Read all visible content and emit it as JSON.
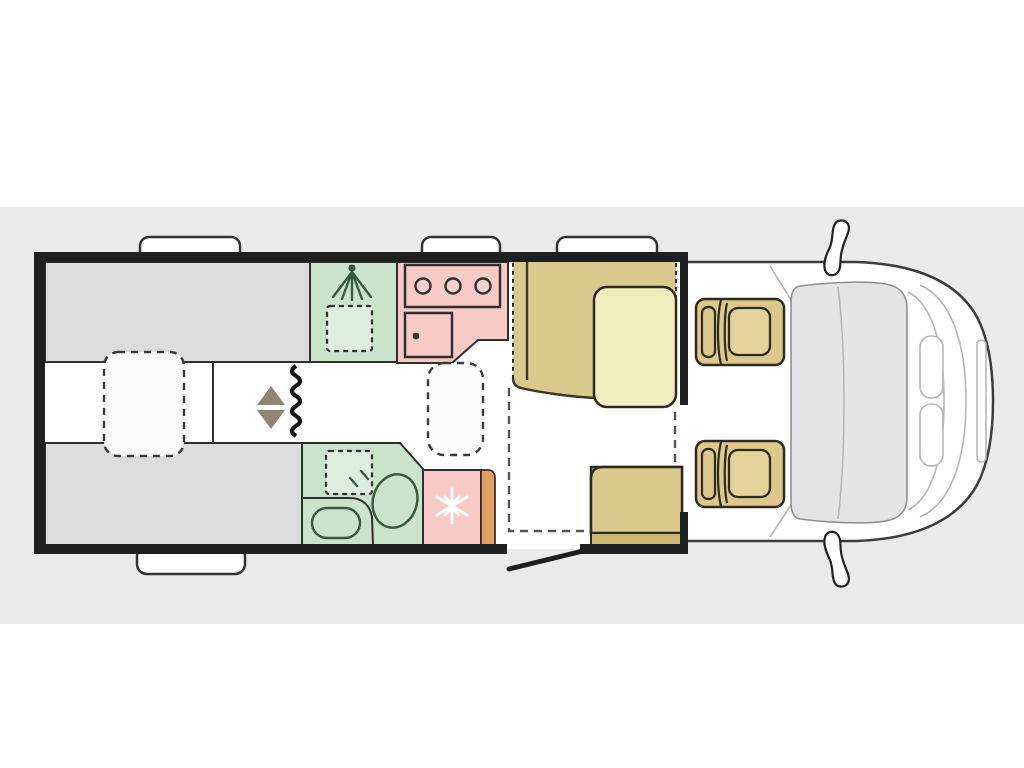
{
  "scene": {
    "type": "motorhome-floorplan-top-view",
    "orientation": "cab-on-right"
  },
  "colors": {
    "band": "#eaeaea",
    "floor": "#ffffff",
    "wall": "#1f1f1f",
    "bed_gray": "#dbdcde",
    "green": "#c9e4cb",
    "green_light": "#dcefdf",
    "green_stroke": "#3a5a40",
    "pink": "#f7cac6",
    "pink_light": "#f9d2ce",
    "orange": "#e2a05e",
    "tan": "#d9c98c",
    "tan_dark": "#ccb771",
    "cream": "#f3edbe",
    "cab_seat": "#dcc88b",
    "cab_cushion": "#e4d29b",
    "windshield": "#e4e4e6",
    "outline": "#2e2a20",
    "line_dark": "#2f2f2f",
    "detail_gray": "#b5b5b5",
    "arrow_gray": "#8d8678"
  },
  "counts": {
    "hob_burners": 3,
    "cab_seats": 2,
    "roof_hatches_top": 3,
    "roof_hatches_bottom": 1,
    "single_beds": 2,
    "tables": 1
  },
  "zones": [
    {
      "name": "rear-twin-beds",
      "color_key": "bed_gray"
    },
    {
      "name": "shower-room",
      "color_key": "green"
    },
    {
      "name": "kitchen",
      "color_key": "pink"
    },
    {
      "name": "washroom",
      "color_key": "green"
    },
    {
      "name": "fridge",
      "color_key": "pink"
    },
    {
      "name": "dinette-lounge",
      "color_key": "tan"
    },
    {
      "name": "cab",
      "color_key": "windshield"
    }
  ],
  "icons": [
    {
      "name": "shower-icon"
    },
    {
      "name": "snowflake-icon"
    },
    {
      "name": "bed-lift-arrows-icon"
    },
    {
      "name": "wardrobe-wave-icon"
    }
  ]
}
